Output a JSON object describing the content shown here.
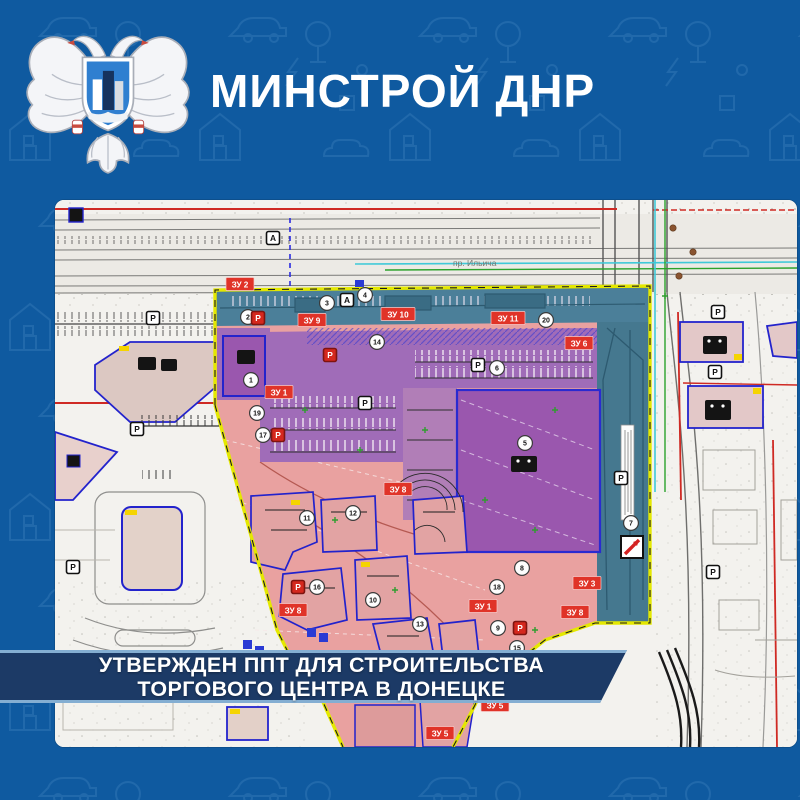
{
  "header": {
    "title": "МИНСТРОЙ ДНР",
    "logo": "minstroy-dnr-emblem"
  },
  "banner": {
    "line1": "УТВЕРЖДЕН ППТ ДЛЯ СТРОИТЕЛЬСТВА",
    "line2": "ТОРГОВОГО ЦЕНТРА В ДОНЕЦКЕ"
  },
  "map": {
    "street_label": "пр. Ильича",
    "parking_label": "Р",
    "bus_stop_label": "А",
    "plot_labels": [
      {
        "text": "ЗУ 2",
        "x": 185,
        "y": 84
      },
      {
        "text": "ЗУ 9",
        "x": 257,
        "y": 120
      },
      {
        "text": "ЗУ 10",
        "x": 343,
        "y": 114
      },
      {
        "text": "ЗУ 11",
        "x": 453,
        "y": 118
      },
      {
        "text": "ЗУ 6",
        "x": 524,
        "y": 143
      },
      {
        "text": "ЗУ 1",
        "x": 224,
        "y": 192
      },
      {
        "text": "ЗУ 8",
        "x": 343,
        "y": 289
      },
      {
        "text": "ЗУ 8",
        "x": 238,
        "y": 410
      },
      {
        "text": "ЗУ 1",
        "x": 428,
        "y": 406
      },
      {
        "text": "ЗУ 3",
        "x": 532,
        "y": 383
      },
      {
        "text": "ЗУ 8",
        "x": 520,
        "y": 412
      },
      {
        "text": "ЗУ 5",
        "x": 440,
        "y": 505
      },
      {
        "text": "ЗУ 5",
        "x": 385,
        "y": 533
      }
    ],
    "markers": [
      {
        "n": "1",
        "x": 196,
        "y": 180
      },
      {
        "n": "2",
        "x": 193,
        "y": 117
      },
      {
        "n": "3",
        "x": 272,
        "y": 103
      },
      {
        "n": "4",
        "x": 310,
        "y": 95
      },
      {
        "n": "5",
        "x": 470,
        "y": 243
      },
      {
        "n": "6",
        "x": 442,
        "y": 168
      },
      {
        "n": "7",
        "x": 576,
        "y": 323
      },
      {
        "n": "8",
        "x": 467,
        "y": 368
      },
      {
        "n": "9",
        "x": 443,
        "y": 428
      },
      {
        "n": "10",
        "x": 318,
        "y": 400
      },
      {
        "n": "11",
        "x": 252,
        "y": 318
      },
      {
        "n": "12",
        "x": 298,
        "y": 313
      },
      {
        "n": "13",
        "x": 365,
        "y": 424
      },
      {
        "n": "14",
        "x": 322,
        "y": 142
      },
      {
        "n": "15",
        "x": 462,
        "y": 448
      },
      {
        "n": "16",
        "x": 262,
        "y": 387
      },
      {
        "n": "17",
        "x": 208,
        "y": 235
      },
      {
        "n": "18",
        "x": 442,
        "y": 387
      },
      {
        "n": "19",
        "x": 202,
        "y": 213
      },
      {
        "n": "20",
        "x": 491,
        "y": 120
      }
    ],
    "parking_black": [
      {
        "x": 98,
        "y": 118
      },
      {
        "x": 82,
        "y": 229
      },
      {
        "x": 18,
        "y": 367
      },
      {
        "x": 310,
        "y": 203
      },
      {
        "x": 423,
        "y": 165
      },
      {
        "x": 663,
        "y": 112
      },
      {
        "x": 660,
        "y": 172
      },
      {
        "x": 658,
        "y": 372
      },
      {
        "x": 566,
        "y": 278
      }
    ],
    "parking_red": [
      {
        "x": 203,
        "y": 118
      },
      {
        "x": 275,
        "y": 155
      },
      {
        "x": 223,
        "y": 235
      },
      {
        "x": 243,
        "y": 387
      },
      {
        "x": 465,
        "y": 428
      }
    ],
    "bus_stops": [
      {
        "x": 218,
        "y": 38
      },
      {
        "x": 292,
        "y": 100
      }
    ],
    "colors": {
      "background_blue": "#0f5aa0",
      "banner_navy": "#1c3a66",
      "banner_edge": "#84aed2",
      "boundary_yellow": "#e4e800",
      "plot_label_bg": "#e03328",
      "zone_pink": "#e9a1a0",
      "zone_purple": "#9a57ae",
      "zone_teal": "#4b7f99",
      "red_line": "#cf2a24",
      "building_outline": "#2323cc"
    }
  }
}
